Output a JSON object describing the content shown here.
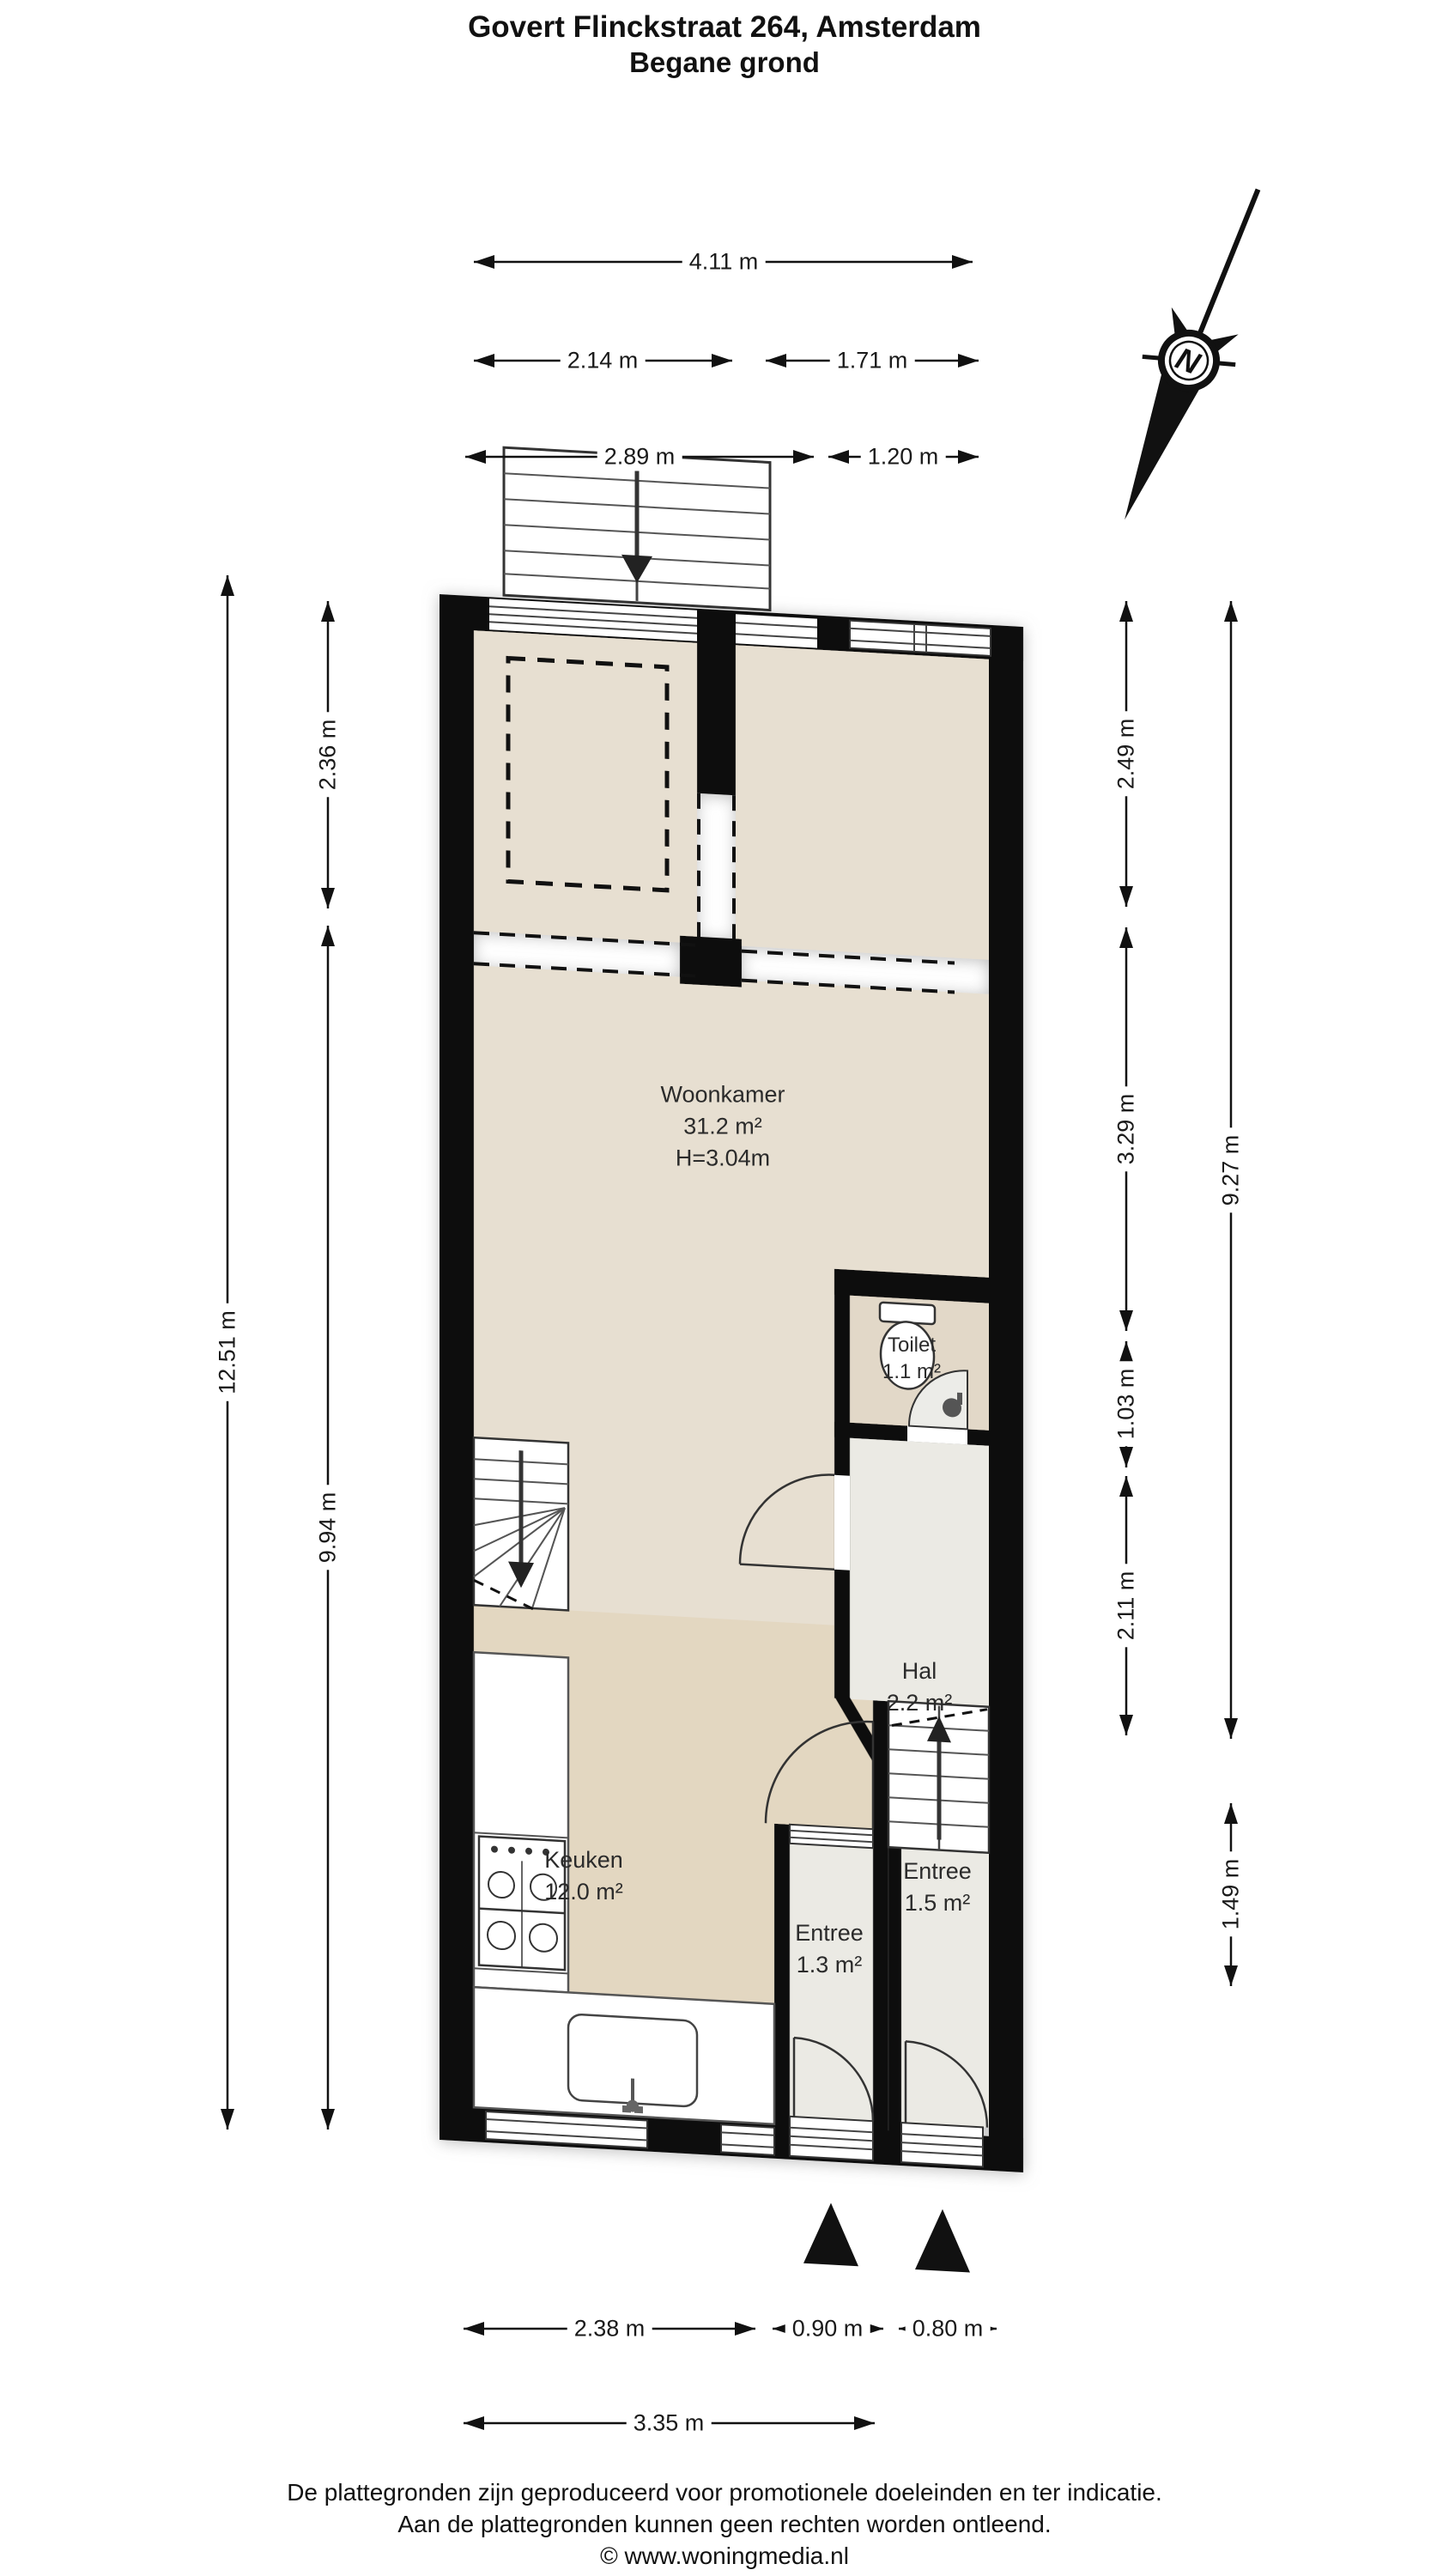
{
  "header": {
    "title": "Govert Flinckstraat 264, Amsterdam",
    "subtitle": "Begane grond"
  },
  "compass": {
    "letter": "N"
  },
  "rooms": {
    "woonkamer": {
      "name": "Woonkamer",
      "area": "31.2 m²",
      "ceiling_height": "H=3.04m"
    },
    "toilet": {
      "name": "Toilet",
      "area": "1.1 m²"
    },
    "hal": {
      "name": "Hal",
      "area": "2.2 m²"
    },
    "keuken": {
      "name": "Keuken",
      "area": "12.0 m²"
    },
    "entree_voor": {
      "name": "Entree",
      "area": "1.3 m²"
    },
    "entree_achter": {
      "name": "Entree",
      "area": "1.5 m²"
    }
  },
  "dimensions": {
    "top": [
      {
        "label": "4.11 m"
      },
      {
        "label": "2.14 m"
      },
      {
        "label": "1.71 m"
      },
      {
        "label": "2.89 m"
      },
      {
        "label": "1.20 m"
      }
    ],
    "left": [
      {
        "label": "12.51 m"
      },
      {
        "label": "2.36 m"
      },
      {
        "label": "9.94 m"
      }
    ],
    "right": [
      {
        "label": "2.49 m"
      },
      {
        "label": "3.29 m"
      },
      {
        "label": "1.03 m"
      },
      {
        "label": "2.11 m"
      },
      {
        "label": "9.27 m"
      },
      {
        "label": "1.49 m"
      }
    ],
    "bottom": [
      {
        "label": "2.38 m"
      },
      {
        "label": "0.90 m"
      },
      {
        "label": "0.80 m"
      },
      {
        "label": "3.35 m"
      }
    ]
  },
  "footer": {
    "line1": "De plattegronden zijn geproduceerd voor promotionele doeleinden en ter indicatie.",
    "line2": "Aan de plattegronden kunnen geen rechten worden ontleend.",
    "line3": "© www.woningmedia.nl"
  },
  "colors": {
    "wall": "#0b0b0b",
    "floor_living": "#e7dfd1",
    "floor_kitchen": "#e3d7c1",
    "floor_hall": "#ebeae4",
    "floor_toilet": "#e2d8c8",
    "line": "#333333"
  }
}
